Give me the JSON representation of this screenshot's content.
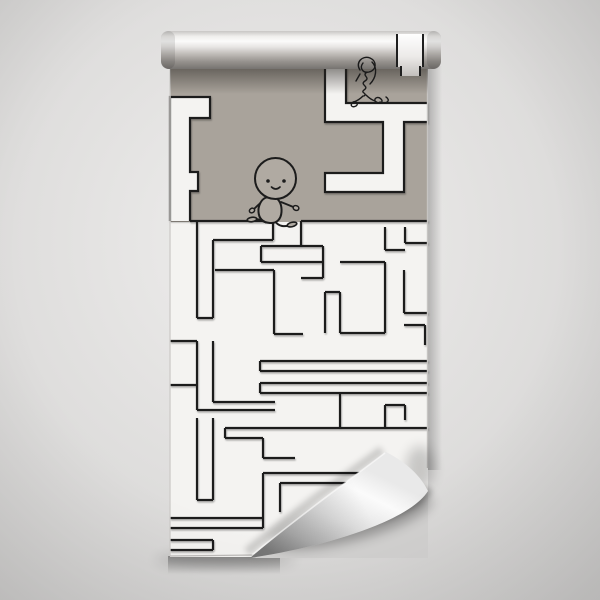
{
  "scene": {
    "kind": "wallpaper-roll-mockup",
    "colors": {
      "bg_center": "#ededec",
      "bg_mid": "#dcdbda",
      "bg_edge": "#c6c5c4",
      "sheet": "#f4f3f1",
      "band": "#a9a39b",
      "channel_fill": "#f4f3f1",
      "line": "#1f1f1f",
      "char_fill": "#b0aaa2",
      "char_line": "#1c1c1c",
      "scribble_line": "#1a1a1a",
      "curl_light": "#fbfbfb",
      "curl_dark": "#979797",
      "cutout_bg": "#d2d1d0",
      "edge_line": "#bdbbb9"
    },
    "band_channels": [
      "M190,221 L190,191 L198,191 L198,172 L190,172 L190,118 L210,118 L210,97 L170,97 L170,221",
      "M428,122 L404,122 L404,192 L325,192 L325,173 L383,173 L383,122 L325,122 L325,66 L346,66 L346,103 L428,103"
    ],
    "maze_segments": [
      [
        190,
        221,
        273,
        221
      ],
      [
        301,
        221,
        428,
        221
      ],
      [
        197,
        221,
        197,
        318
      ],
      [
        213,
        240,
        213,
        318
      ],
      [
        197,
        318,
        213,
        318
      ],
      [
        213,
        240,
        273,
        240
      ],
      [
        273,
        221,
        273,
        240
      ],
      [
        301,
        221,
        301,
        246
      ],
      [
        261,
        246,
        323,
        246
      ],
      [
        261,
        246,
        261,
        262
      ],
      [
        261,
        262,
        323,
        262
      ],
      [
        323,
        246,
        323,
        278
      ],
      [
        301,
        278,
        323,
        278
      ],
      [
        340,
        262,
        385,
        262
      ],
      [
        385,
        227,
        385,
        250
      ],
      [
        385,
        250,
        405,
        250
      ],
      [
        405,
        227,
        405,
        243
      ],
      [
        405,
        243,
        428,
        243
      ],
      [
        385,
        262,
        385,
        333
      ],
      [
        340,
        333,
        385,
        333
      ],
      [
        325,
        292,
        325,
        333
      ],
      [
        340,
        292,
        340,
        333
      ],
      [
        325,
        292,
        340,
        292
      ],
      [
        404,
        270,
        404,
        313
      ],
      [
        404,
        313,
        428,
        313
      ],
      [
        404,
        325,
        425,
        325
      ],
      [
        425,
        325,
        425,
        345
      ],
      [
        215,
        270,
        274,
        270
      ],
      [
        274,
        270,
        274,
        334
      ],
      [
        274,
        334,
        303,
        334
      ],
      [
        170,
        341,
        197,
        341
      ],
      [
        197,
        341,
        197,
        410
      ],
      [
        213,
        341,
        213,
        402
      ],
      [
        213,
        402,
        275,
        402
      ],
      [
        197,
        410,
        275,
        410
      ],
      [
        260,
        361,
        428,
        361
      ],
      [
        260,
        361,
        260,
        371
      ],
      [
        260,
        371,
        428,
        371
      ],
      [
        260,
        383,
        428,
        383
      ],
      [
        260,
        383,
        260,
        393
      ],
      [
        260,
        393,
        428,
        393
      ],
      [
        170,
        385,
        197,
        385
      ],
      [
        225,
        428,
        428,
        428
      ],
      [
        225,
        428,
        225,
        438
      ],
      [
        225,
        438,
        263,
        438
      ],
      [
        263,
        438,
        263,
        458
      ],
      [
        263,
        458,
        295,
        458
      ],
      [
        340,
        393,
        340,
        428
      ],
      [
        385,
        405,
        405,
        405
      ],
      [
        385,
        405,
        385,
        428
      ],
      [
        405,
        405,
        405,
        420
      ],
      [
        197,
        418,
        197,
        500
      ],
      [
        213,
        418,
        213,
        500
      ],
      [
        197,
        500,
        213,
        500
      ],
      [
        263,
        473,
        360,
        473
      ],
      [
        280,
        483,
        360,
        483
      ],
      [
        263,
        473,
        263,
        528
      ],
      [
        280,
        483,
        280,
        512
      ],
      [
        170,
        518,
        263,
        518
      ],
      [
        170,
        528,
        263,
        528
      ],
      [
        170,
        540,
        213,
        540
      ],
      [
        170,
        550,
        213,
        550
      ],
      [
        213,
        540,
        213,
        550
      ]
    ]
  }
}
